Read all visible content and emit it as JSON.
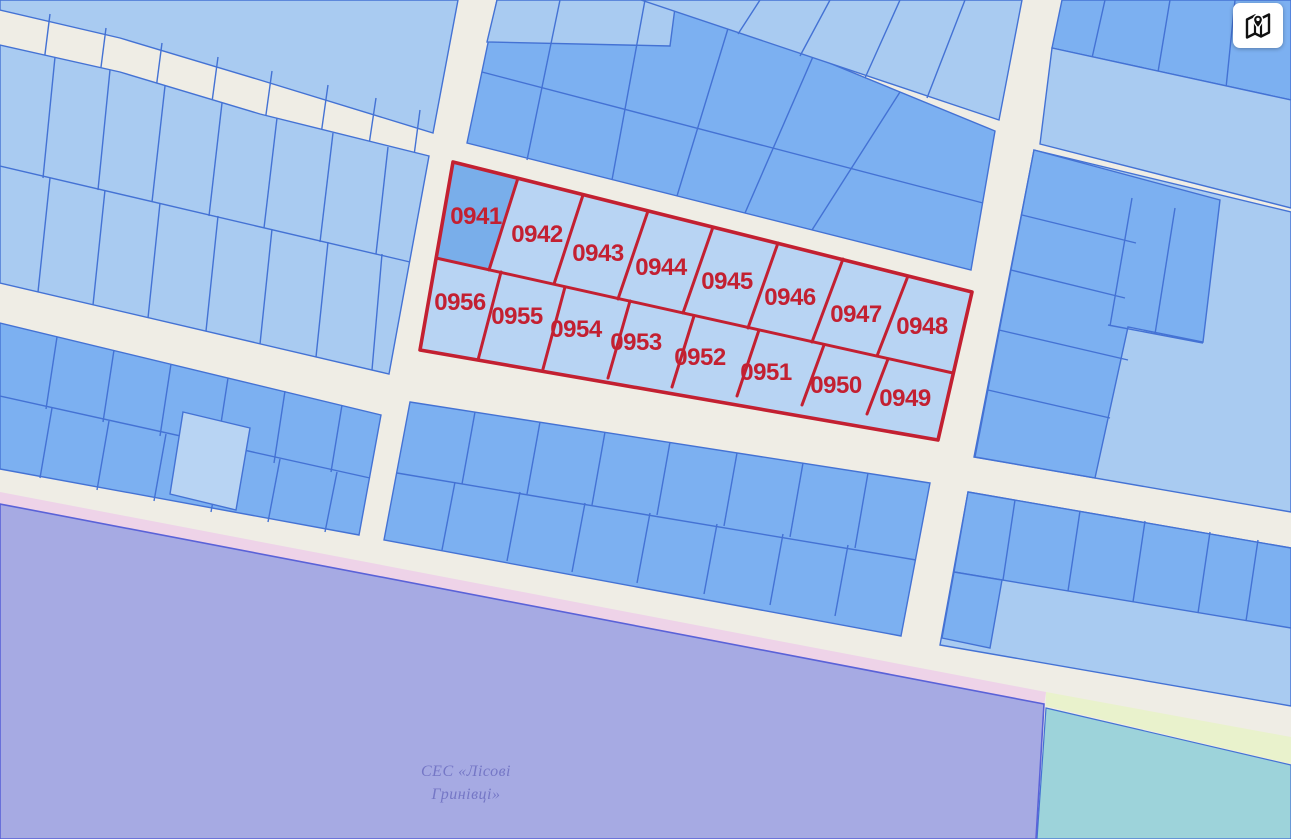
{
  "map": {
    "type": "cadastral-parcel-map",
    "highlighted_parcels": [
      {
        "number": "0941",
        "x": 476,
        "y": 216
      },
      {
        "number": "0942",
        "x": 537,
        "y": 234
      },
      {
        "number": "0943",
        "x": 598,
        "y": 253
      },
      {
        "number": "0944",
        "x": 661,
        "y": 267
      },
      {
        "number": "0945",
        "x": 727,
        "y": 281
      },
      {
        "number": "0946",
        "x": 790,
        "y": 297
      },
      {
        "number": "0947",
        "x": 856,
        "y": 314
      },
      {
        "number": "0948",
        "x": 922,
        "y": 326
      },
      {
        "number": "0949",
        "x": 905,
        "y": 398
      },
      {
        "number": "0950",
        "x": 836,
        "y": 385
      },
      {
        "number": "0951",
        "x": 766,
        "y": 372
      },
      {
        "number": "0952",
        "x": 700,
        "y": 357
      },
      {
        "number": "0953",
        "x": 636,
        "y": 342
      },
      {
        "number": "0954",
        "x": 576,
        "y": 329
      },
      {
        "number": "0955",
        "x": 517,
        "y": 316
      },
      {
        "number": "0956",
        "x": 460,
        "y": 302
      }
    ],
    "zone_label": {
      "line1": "СЕС «Лісові",
      "line2": "Гринівці»",
      "x": 466,
      "y1": 776,
      "y2": 799
    },
    "colors": {
      "road": "#efede5",
      "parcel_light": "#a9cbf1",
      "parcel_lighter": "#b8d4f3",
      "parcel_medium": "#7cb0f1",
      "parcel_medium_dark": "#79aeea",
      "parcel_border": "#4472d4",
      "highlight_red": "#c32031",
      "zone_purple": "#a6aae3",
      "zone_purple_border": "#5a62d8",
      "zone_pink": "#eed3e8",
      "zone_teal": "#9dd3da",
      "zone_green": "#e9f2cc",
      "zone_label_color": "#7577c6",
      "button_bg": "#ffffff",
      "button_icon": "#111111"
    }
  },
  "controls": {
    "map_button": {
      "icon": "map-pin-icon",
      "tooltip_none_visible": ""
    }
  }
}
